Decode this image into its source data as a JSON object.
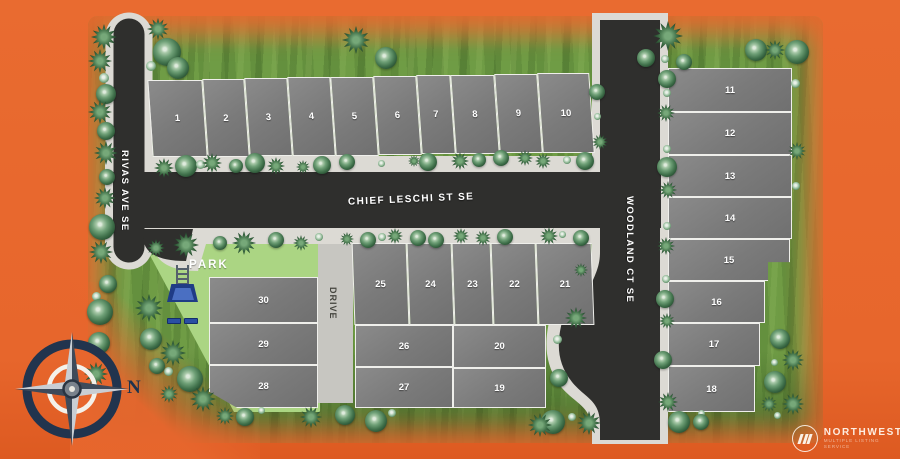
{
  "meta": {
    "description": "Residential plat site map with 30 numbered lots, streets, park, compass rose and Northwest MLS watermark"
  },
  "colors": {
    "background_orange": "#E7662C",
    "grass": "#6F9C45",
    "park_green": "#ABD583",
    "asphalt": "#2F2F2D",
    "sidewalk": "#DCDAD4",
    "driveway": "#C7C6C1",
    "lot_gray": "#7E7E7E",
    "lot_border": "#EFEFEB",
    "compass_navy": "#21344E",
    "playground_blue": "#2A4FA3"
  },
  "streets": {
    "chief": "CHIEF LESCHI ST SE",
    "rivas": "RIVAS AVE SE",
    "woodland": "WOODLAND CT SE",
    "drive": "DRIVE"
  },
  "park": {
    "label": "PARK"
  },
  "compass": {
    "label": "N"
  },
  "logo": {
    "name": "NORTHWEST",
    "tagline": "MULTIPLE LISTING SERVICE"
  },
  "lots": [
    {
      "n": "1",
      "x": 150,
      "y": 80,
      "w": 55,
      "h": 77,
      "skew": 4
    },
    {
      "n": "2",
      "x": 205,
      "y": 79,
      "w": 42,
      "h": 78,
      "skew": 4
    },
    {
      "n": "3",
      "x": 247,
      "y": 78,
      "w": 43,
      "h": 78,
      "skew": 4
    },
    {
      "n": "4",
      "x": 290,
      "y": 77,
      "w": 43,
      "h": 79,
      "skew": 4
    },
    {
      "n": "5",
      "x": 333,
      "y": 77,
      "w": 43,
      "h": 79,
      "skew": 4
    },
    {
      "n": "6",
      "x": 376,
      "y": 76,
      "w": 43,
      "h": 79,
      "skew": 4
    },
    {
      "n": "7",
      "x": 419,
      "y": 75,
      "w": 34,
      "h": 79,
      "skew": 4
    },
    {
      "n": "8",
      "x": 453,
      "y": 75,
      "w": 44,
      "h": 79,
      "skew": 4
    },
    {
      "n": "9",
      "x": 497,
      "y": 74,
      "w": 43,
      "h": 79,
      "skew": 4
    },
    {
      "n": "10",
      "x": 540,
      "y": 73,
      "w": 52,
      "h": 80,
      "skew": 4
    },
    {
      "n": "11",
      "x": 668,
      "y": 68,
      "w": 124,
      "h": 44
    },
    {
      "n": "12",
      "x": 668,
      "y": 112,
      "w": 124,
      "h": 43
    },
    {
      "n": "13",
      "x": 668,
      "y": 155,
      "w": 124,
      "h": 42
    },
    {
      "n": "14",
      "x": 668,
      "y": 197,
      "w": 124,
      "h": 42
    },
    {
      "n": "15",
      "x": 668,
      "y": 239,
      "w": 122,
      "h": 42,
      "clip": "polygon(0 0,100% 0,100% 55%,82% 55%,82% 100%,0 100%)"
    },
    {
      "n": "16",
      "x": 668,
      "y": 281,
      "w": 97,
      "h": 42
    },
    {
      "n": "17",
      "x": 668,
      "y": 323,
      "w": 92,
      "h": 43
    },
    {
      "n": "18",
      "x": 668,
      "y": 366,
      "w": 87,
      "h": 46
    },
    {
      "n": "19",
      "x": 453,
      "y": 368,
      "w": 93,
      "h": 40
    },
    {
      "n": "20",
      "x": 453,
      "y": 325,
      "w": 93,
      "h": 43
    },
    {
      "n": "21",
      "x": 537,
      "y": 243,
      "w": 56,
      "h": 82,
      "skew": 2
    },
    {
      "n": "22",
      "x": 492,
      "y": 243,
      "w": 45,
      "h": 82,
      "skew": 2
    },
    {
      "n": "23",
      "x": 453,
      "y": 243,
      "w": 39,
      "h": 82,
      "skew": 2
    },
    {
      "n": "24",
      "x": 408,
      "y": 243,
      "w": 45,
      "h": 82,
      "skew": 2
    },
    {
      "n": "25",
      "x": 353,
      "y": 243,
      "w": 55,
      "h": 82,
      "skew": 2
    },
    {
      "n": "26",
      "x": 355,
      "y": 325,
      "w": 98,
      "h": 42
    },
    {
      "n": "27",
      "x": 355,
      "y": 367,
      "w": 98,
      "h": 41
    },
    {
      "n": "28",
      "x": 209,
      "y": 365,
      "w": 109,
      "h": 43,
      "clip": "polygon(0 0,100% 0,100% 100%,26% 100%,0 62%)"
    },
    {
      "n": "29",
      "x": 209,
      "y": 323,
      "w": 109,
      "h": 42
    },
    {
      "n": "30",
      "x": 209,
      "y": 277,
      "w": 109,
      "h": 46
    }
  ],
  "trees": [
    [
      "s",
      104,
      37,
      26
    ],
    [
      "s",
      100,
      61,
      24
    ],
    [
      "c",
      104,
      78,
      10
    ],
    [
      "r",
      106,
      94,
      20
    ],
    [
      "s",
      100,
      112,
      24
    ],
    [
      "r",
      106,
      131,
      18
    ],
    [
      "s",
      106,
      153,
      24
    ],
    [
      "r",
      107,
      177,
      16
    ],
    [
      "s",
      105,
      198,
      22
    ],
    [
      "r",
      102,
      227,
      26
    ],
    [
      "s",
      101,
      252,
      24
    ],
    [
      "r",
      108,
      284,
      18
    ],
    [
      "c",
      96,
      296,
      9
    ],
    [
      "r",
      100,
      312,
      26
    ],
    [
      "r",
      99,
      343,
      22
    ],
    [
      "s",
      96,
      374,
      24
    ],
    [
      "s",
      149,
      308,
      28
    ],
    [
      "r",
      151,
      339,
      22
    ],
    [
      "s",
      173,
      353,
      26
    ],
    [
      "c",
      168,
      371,
      9
    ],
    [
      "r",
      190,
      379,
      26
    ],
    [
      "s",
      169,
      394,
      18
    ],
    [
      "s",
      203,
      399,
      26
    ],
    [
      "r",
      157,
      366,
      16
    ],
    [
      "s",
      158,
      29,
      22
    ],
    [
      "r",
      167,
      52,
      28
    ],
    [
      "c",
      151,
      66,
      10
    ],
    [
      "r",
      178,
      68,
      22
    ],
    [
      "s",
      356,
      40,
      28
    ],
    [
      "r",
      386,
      58,
      22
    ],
    [
      "r",
      646,
      58,
      18
    ],
    [
      "s",
      668,
      36,
      30
    ],
    [
      "c",
      665,
      59,
      8
    ],
    [
      "r",
      684,
      62,
      16
    ],
    [
      "r",
      756,
      50,
      22
    ],
    [
      "s",
      775,
      50,
      20
    ],
    [
      "r",
      797,
      52,
      24
    ],
    [
      "s",
      164,
      168,
      20
    ],
    [
      "r",
      186,
      166,
      22
    ],
    [
      "c",
      200,
      164,
      9
    ],
    [
      "s",
      212,
      163,
      20
    ],
    [
      "r",
      236,
      166,
      14
    ],
    [
      "r",
      255,
      163,
      20
    ],
    [
      "s",
      276,
      166,
      18
    ],
    [
      "s",
      303,
      167,
      14
    ],
    [
      "r",
      322,
      165,
      18
    ],
    [
      "r",
      347,
      162,
      16
    ],
    [
      "c",
      381,
      163,
      7
    ],
    [
      "s",
      414,
      161,
      12
    ],
    [
      "r",
      428,
      162,
      18
    ],
    [
      "s",
      460,
      161,
      18
    ],
    [
      "r",
      479,
      160,
      14
    ],
    [
      "r",
      501,
      158,
      16
    ],
    [
      "s",
      525,
      158,
      16
    ],
    [
      "s",
      543,
      161,
      16
    ],
    [
      "c",
      567,
      160,
      8
    ],
    [
      "r",
      585,
      161,
      18
    ],
    [
      "r",
      597,
      92,
      16
    ],
    [
      "c",
      597,
      116,
      7
    ],
    [
      "s",
      600,
      142,
      16
    ],
    [
      "s",
      156,
      248,
      18
    ],
    [
      "s",
      186,
      245,
      26
    ],
    [
      "r",
      220,
      243,
      14
    ],
    [
      "s",
      244,
      243,
      24
    ],
    [
      "r",
      276,
      240,
      16
    ],
    [
      "s",
      301,
      243,
      16
    ],
    [
      "c",
      319,
      237,
      8
    ],
    [
      "s",
      347,
      239,
      14
    ],
    [
      "r",
      368,
      240,
      16
    ],
    [
      "c",
      382,
      237,
      8
    ],
    [
      "s",
      395,
      236,
      16
    ],
    [
      "r",
      418,
      238,
      16
    ],
    [
      "r",
      436,
      240,
      16
    ],
    [
      "s",
      461,
      236,
      16
    ],
    [
      "s",
      483,
      238,
      16
    ],
    [
      "r",
      505,
      237,
      16
    ],
    [
      "s",
      549,
      236,
      18
    ],
    [
      "c",
      562,
      234,
      7
    ],
    [
      "r",
      581,
      238,
      16
    ],
    [
      "s",
      581,
      270,
      14
    ],
    [
      "s",
      576,
      318,
      22
    ],
    [
      "c",
      557,
      339,
      9
    ],
    [
      "r",
      559,
      378,
      18
    ],
    [
      "r",
      553,
      422,
      24
    ],
    [
      "c",
      572,
      417,
      8
    ],
    [
      "s",
      589,
      423,
      24
    ],
    [
      "r",
      667,
      79,
      18
    ],
    [
      "c",
      667,
      93,
      8
    ],
    [
      "s",
      666,
      113,
      18
    ],
    [
      "c",
      667,
      149,
      8
    ],
    [
      "r",
      667,
      167,
      20
    ],
    [
      "s",
      668,
      190,
      18
    ],
    [
      "c",
      667,
      226,
      8
    ],
    [
      "s",
      666,
      246,
      18
    ],
    [
      "c",
      666,
      279,
      8
    ],
    [
      "r",
      665,
      299,
      18
    ],
    [
      "s",
      667,
      321,
      16
    ],
    [
      "r",
      663,
      360,
      18
    ],
    [
      "s",
      668,
      402,
      20
    ],
    [
      "c",
      795,
      83,
      9
    ],
    [
      "s",
      797,
      151,
      18
    ],
    [
      "c",
      796,
      186,
      8
    ],
    [
      "r",
      780,
      339,
      20
    ],
    [
      "s",
      793,
      360,
      22
    ],
    [
      "c",
      774,
      362,
      7
    ],
    [
      "r",
      775,
      382,
      22
    ],
    [
      "s",
      769,
      404,
      16
    ],
    [
      "s",
      793,
      404,
      22
    ],
    [
      "c",
      777,
      415,
      7
    ],
    [
      "r",
      679,
      422,
      22
    ],
    [
      "c",
      701,
      413,
      7
    ],
    [
      "r",
      701,
      422,
      16
    ],
    [
      "s",
      225,
      416,
      18
    ],
    [
      "r",
      245,
      417,
      18
    ],
    [
      "c",
      261,
      410,
      7
    ],
    [
      "s",
      311,
      417,
      22
    ],
    [
      "r",
      345,
      415,
      20
    ],
    [
      "r",
      376,
      421,
      22
    ],
    [
      "c",
      392,
      413,
      8
    ],
    [
      "s",
      540,
      425,
      24
    ]
  ]
}
